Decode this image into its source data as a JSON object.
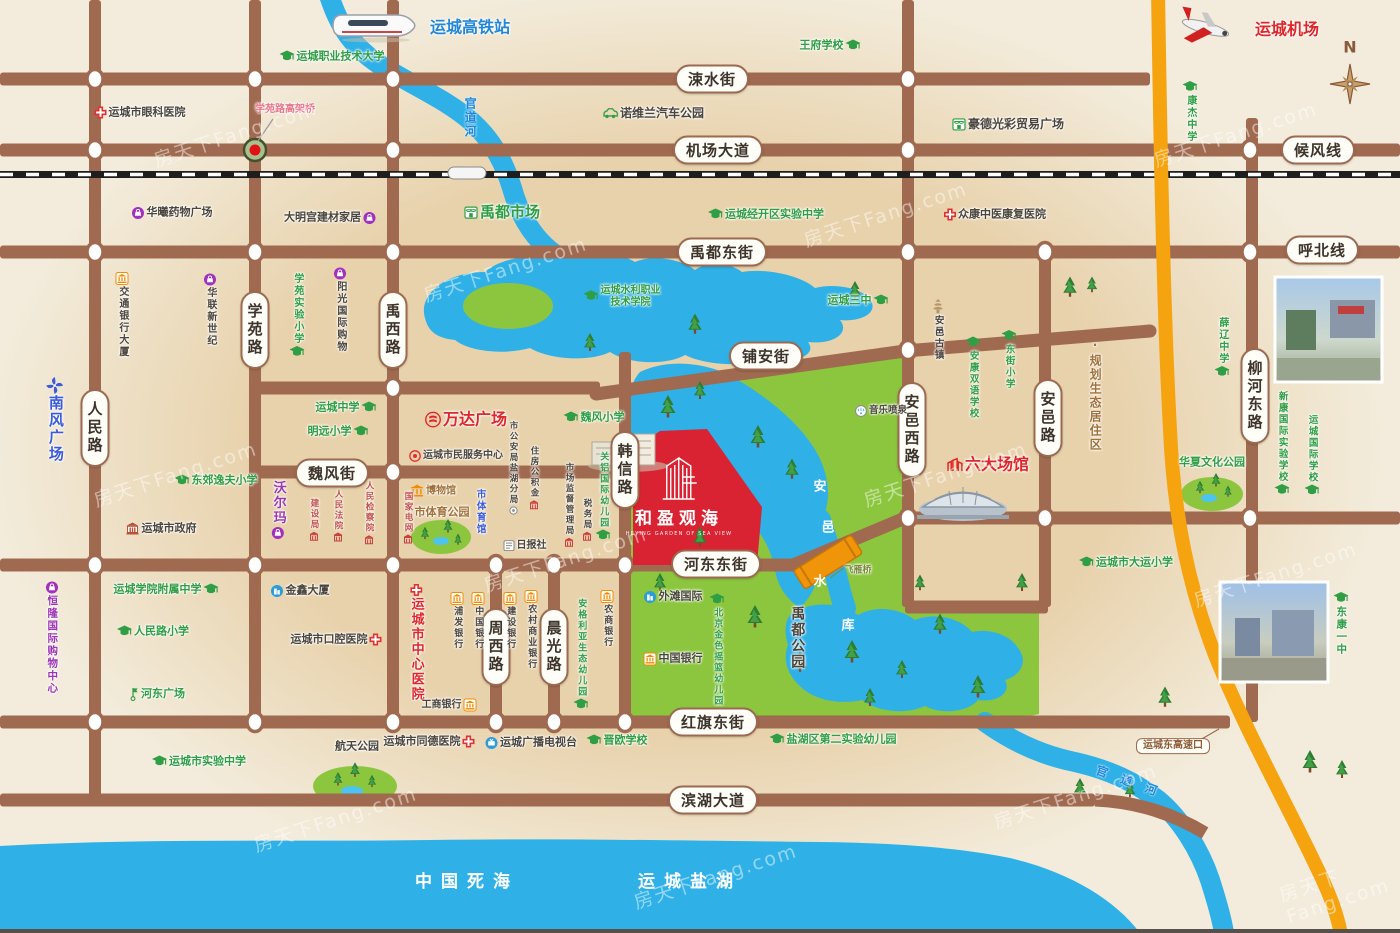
{
  "map": {
    "watermark": "房天下Fang.com",
    "compass_label": "N",
    "project": {
      "name": "和盈观海",
      "subtitle": "HEYING GARDEN OF SEA VIEW"
    },
    "colors": {
      "background": "#f3ecdc",
      "sand_zone": "#e8d2ac",
      "road": "#a06a50",
      "water": "#2fb1e8",
      "park": "#8cc63e",
      "highway": "#f5a40f",
      "project_red": "#da2332",
      "school_green": "#2f9e44",
      "landmark_red": "#e0262a",
      "shopping_purple": "#9c36b5",
      "bank_orange": "#f08c00"
    },
    "road_pills": [
      {
        "t": "涑水街",
        "x": 712,
        "y": 79
      },
      {
        "t": "机场大道",
        "x": 718,
        "y": 150
      },
      {
        "t": "候风线",
        "x": 1318,
        "y": 150
      },
      {
        "t": "禹都东街",
        "x": 722,
        "y": 252
      },
      {
        "t": "呼北线",
        "x": 1322,
        "y": 250
      },
      {
        "t": "铺安街",
        "x": 766,
        "y": 356
      },
      {
        "t": "学苑路",
        "x": 255,
        "y": 330,
        "v": true
      },
      {
        "t": "禹西路",
        "x": 393,
        "y": 330,
        "v": true
      },
      {
        "t": "人民路",
        "x": 95,
        "y": 428,
        "v": true
      },
      {
        "t": "魏风街",
        "x": 332,
        "y": 473
      },
      {
        "t": "韩信路",
        "x": 625,
        "y": 470,
        "v": true
      },
      {
        "t": "河东东街",
        "x": 716,
        "y": 564
      },
      {
        "t": "安邑西路",
        "x": 912,
        "y": 430,
        "v": true
      },
      {
        "t": "安邑路",
        "x": 1048,
        "y": 418,
        "v": true
      },
      {
        "t": "柳河东路",
        "x": 1255,
        "y": 396,
        "v": true
      },
      {
        "t": "周西路",
        "x": 496,
        "y": 647,
        "v": true
      },
      {
        "t": "晨光路",
        "x": 554,
        "y": 647,
        "v": true
      },
      {
        "t": "红旗东街",
        "x": 713,
        "y": 722
      },
      {
        "t": "滨湖大道",
        "x": 713,
        "y": 800
      }
    ],
    "pois": [
      {
        "t": "运城高铁站",
        "x": 470,
        "y": 28,
        "c": "blue",
        "fs": 16,
        "b": true
      },
      {
        "t": "运城职业技术大学",
        "x": 332,
        "y": 57,
        "c": "green",
        "i": "cap",
        "ip": "l",
        "fs": 11
      },
      {
        "t": "王府学校",
        "x": 830,
        "y": 46,
        "c": "green",
        "i": "cap",
        "ip": "r",
        "fs": 11
      },
      {
        "t": "运城机场",
        "x": 1287,
        "y": 30,
        "c": "red",
        "fs": 16,
        "b": true
      },
      {
        "t": "康杰中学",
        "x": 1190,
        "y": 112,
        "c": "green",
        "i": "cap",
        "ip": "t",
        "v": true,
        "fs": 10
      },
      {
        "t": "运城市眼科医院",
        "x": 140,
        "y": 113,
        "c": "dark",
        "i": "cross",
        "ip": "l",
        "fs": 11
      },
      {
        "t": "学苑路高架桥",
        "x": 285,
        "y": 110,
        "c": "pink",
        "fs": 10
      },
      {
        "t": "诺维兰汽车公园",
        "x": 653,
        "y": 113,
        "c": "dark",
        "i": "car",
        "ip": "l",
        "fs": 12
      },
      {
        "t": "豪德光彩贸易广场",
        "x": 1008,
        "y": 124,
        "c": "dark",
        "i": "market",
        "ip": "l",
        "fs": 12
      },
      {
        "t": "华曦药物广场",
        "x": 172,
        "y": 213,
        "c": "dark",
        "i": "shop",
        "ip": "l",
        "fs": 11
      },
      {
        "t": "大明宫建材家居",
        "x": 330,
        "y": 218,
        "c": "dark",
        "i": "shop",
        "ip": "r",
        "fs": 11
      },
      {
        "t": "禹都市场",
        "x": 502,
        "y": 213,
        "c": "green",
        "i": "market",
        "ip": "l",
        "fs": 15,
        "b": true
      },
      {
        "t": "运城经开区实验中学",
        "x": 766,
        "y": 215,
        "c": "green",
        "i": "cap",
        "ip": "l",
        "fs": 11
      },
      {
        "t": "众康中医康复医院",
        "x": 995,
        "y": 215,
        "c": "dark",
        "i": "cross",
        "ip": "l",
        "fs": 11
      },
      {
        "t": "交通银行大厦",
        "x": 122,
        "y": 315,
        "c": "dark",
        "i": "bank",
        "ip": "t",
        "v": true,
        "fs": 10
      },
      {
        "t": "华联新世纪",
        "x": 210,
        "y": 310,
        "c": "dark",
        "i": "shop",
        "ip": "t",
        "v": true,
        "fs": 10
      },
      {
        "t": "学苑实验小学",
        "x": 297,
        "y": 316,
        "c": "green",
        "i": "cap",
        "ip": "b",
        "v": true,
        "fs": 10
      },
      {
        "t": "阳光国际购物",
        "x": 340,
        "y": 310,
        "c": "dark",
        "i": "shop",
        "ip": "t",
        "v": true,
        "fs": 10
      },
      {
        "t": "南风广场",
        "x": 55,
        "y": 420,
        "c": "blue2",
        "i": "pinwheel",
        "ip": "t",
        "v": true,
        "fs": 15,
        "b": true
      },
      {
        "t": "运城水利职业\n技术学院",
        "x": 622,
        "y": 297,
        "c": "green",
        "i": "cap",
        "ip": "l",
        "fs": 10
      },
      {
        "t": "运城中学",
        "x": 346,
        "y": 408,
        "c": "green",
        "i": "cap",
        "ip": "r",
        "fs": 11
      },
      {
        "t": "明远小学",
        "x": 338,
        "y": 432,
        "c": "green",
        "i": "cap",
        "ip": "r",
        "fs": 11
      },
      {
        "t": "万达广场",
        "x": 466,
        "y": 420,
        "c": "red",
        "i": "wanda",
        "ip": "l",
        "fs": 16,
        "b": true
      },
      {
        "t": "运城市民服务中心",
        "x": 456,
        "y": 456,
        "c": "dark",
        "i": "serving",
        "ip": "l",
        "fs": 10
      },
      {
        "t": "博物馆",
        "x": 433,
        "y": 491,
        "c": "brown",
        "i": "museum",
        "ip": "l",
        "fs": 10
      },
      {
        "t": "市体育公园",
        "x": 442,
        "y": 513,
        "c": "brown",
        "fs": 11,
        "b": true
      },
      {
        "t": "市体育馆",
        "x": 480,
        "y": 512,
        "c": "blue2",
        "v": true,
        "fs": 9.5
      },
      {
        "t": "国家电网",
        "x": 408,
        "y": 518,
        "c": "darkred",
        "v": true,
        "fs": 8.5,
        "i": "redb",
        "ip": "b"
      },
      {
        "t": "日报社",
        "x": 525,
        "y": 546,
        "c": "dark",
        "i": "np",
        "ip": "l",
        "fs": 10
      },
      {
        "t": "市公安局盐湖分局",
        "x": 513,
        "y": 468,
        "c": "dark",
        "v": true,
        "fs": 8.5,
        "i": "dot",
        "ip": "b"
      },
      {
        "t": "住房公积金",
        "x": 534,
        "y": 478,
        "c": "dark",
        "v": true,
        "fs": 8.5,
        "i": "redb",
        "ip": "b"
      },
      {
        "t": "市场监督管理局",
        "x": 569,
        "y": 505,
        "c": "dark",
        "v": true,
        "fs": 8.5,
        "i": "redb",
        "ip": "b"
      },
      {
        "t": "税务局",
        "x": 587,
        "y": 520,
        "c": "dark",
        "v": true,
        "fs": 8.5,
        "i": "redb",
        "ip": "b"
      },
      {
        "t": "魏风小学",
        "x": 594,
        "y": 418,
        "c": "green",
        "i": "cap",
        "ip": "l",
        "fs": 11
      },
      {
        "t": "关铝国际幼儿园",
        "x": 603,
        "y": 497,
        "c": "green",
        "i": "cap",
        "ip": "b",
        "v": true,
        "fs": 9
      },
      {
        "t": "沃尔玛",
        "x": 278,
        "y": 510,
        "c": "purple",
        "i": "shop",
        "ip": "b",
        "v": true,
        "fs": 13,
        "b": true
      },
      {
        "t": "建设局",
        "x": 314,
        "y": 520,
        "c": "darkred",
        "v": true,
        "fs": 8.5,
        "i": "redb",
        "ip": "b"
      },
      {
        "t": "人民法院",
        "x": 338,
        "y": 516,
        "c": "darkred",
        "v": true,
        "fs": 8.5,
        "i": "redb",
        "ip": "b"
      },
      {
        "t": "人民检察院",
        "x": 369,
        "y": 513,
        "c": "darkred",
        "v": true,
        "fs": 8.5,
        "i": "redb",
        "ip": "b"
      },
      {
        "t": "东郊逸夫小学",
        "x": 216,
        "y": 481,
        "c": "green",
        "i": "cap",
        "ip": "l",
        "fs": 11
      },
      {
        "t": "运城市政府",
        "x": 161,
        "y": 529,
        "c": "dark",
        "i": "gov",
        "ip": "l",
        "fs": 11
      },
      {
        "t": "恒隆国际购物中心",
        "x": 52,
        "y": 638,
        "c": "purple",
        "i": "shop",
        "ip": "t",
        "v": true,
        "fs": 10.5
      },
      {
        "t": "运城学院附属中学",
        "x": 166,
        "y": 590,
        "c": "green",
        "i": "cap",
        "ip": "r",
        "fs": 11
      },
      {
        "t": "人民路小学",
        "x": 153,
        "y": 632,
        "c": "green",
        "i": "cap",
        "ip": "l",
        "fs": 11
      },
      {
        "t": "河东广场",
        "x": 156,
        "y": 694,
        "c": "green",
        "i": "flag",
        "ip": "l",
        "fs": 11
      },
      {
        "t": "金鑫大厦",
        "x": 300,
        "y": 591,
        "c": "dark",
        "i": "bldg",
        "ip": "l",
        "fs": 11
      },
      {
        "t": "运城市口腔医院",
        "x": 336,
        "y": 640,
        "c": "dark",
        "i": "cross",
        "ip": "r",
        "fs": 11
      },
      {
        "t": "运城市中心医院",
        "x": 416,
        "y": 643,
        "c": "red",
        "i": "cross",
        "ip": "t",
        "v": true,
        "fs": 13,
        "b": true
      },
      {
        "t": "浦发银行",
        "x": 457,
        "y": 621,
        "c": "dark",
        "i": "bank",
        "ip": "t",
        "v": true,
        "fs": 9
      },
      {
        "t": "中国银行",
        "x": 478,
        "y": 621,
        "c": "dark",
        "i": "bank",
        "ip": "t",
        "v": true,
        "fs": 9
      },
      {
        "t": "建设银行",
        "x": 510,
        "y": 621,
        "c": "dark",
        "i": "bank",
        "ip": "t",
        "v": true,
        "fs": 9
      },
      {
        "t": "农村商业银行",
        "x": 531,
        "y": 630,
        "c": "dark",
        "i": "bank",
        "ip": "t",
        "v": true,
        "fs": 9
      },
      {
        "t": "农商银行",
        "x": 607,
        "y": 619,
        "c": "dark",
        "i": "bank",
        "ip": "t",
        "v": true,
        "fs": 9
      },
      {
        "t": "安格利亚生态幼儿园",
        "x": 581,
        "y": 655,
        "c": "green",
        "i": "cap",
        "ip": "b",
        "v": true,
        "fs": 9
      },
      {
        "t": "工商银行",
        "x": 449,
        "y": 705,
        "c": "dark",
        "i": "bank",
        "ip": "r",
        "fs": 10
      },
      {
        "t": "中国银行",
        "x": 673,
        "y": 659,
        "c": "dark",
        "i": "bank",
        "ip": "l",
        "fs": 11
      },
      {
        "t": "外滩国际",
        "x": 673,
        "y": 597,
        "c": "dark",
        "i": "bldg",
        "ip": "l",
        "fs": 11
      },
      {
        "t": "北京金色摇篮幼儿园",
        "x": 717,
        "y": 650,
        "c": "green",
        "i": "cap",
        "ip": "t",
        "v": true,
        "fs": 9
      },
      {
        "t": "运城市同德医院",
        "x": 429,
        "y": 742,
        "c": "dark",
        "i": "cross",
        "ip": "r",
        "fs": 11
      },
      {
        "t": "运城广播电视台",
        "x": 531,
        "y": 743,
        "c": "dark",
        "i": "tv",
        "ip": "l",
        "fs": 11
      },
      {
        "t": "晋欧学校",
        "x": 617,
        "y": 741,
        "c": "green",
        "i": "cap",
        "ip": "l",
        "fs": 11
      },
      {
        "t": "盐湖区第二实验幼儿园",
        "x": 833,
        "y": 740,
        "c": "green",
        "i": "cap",
        "ip": "l",
        "fs": 11
      },
      {
        "t": "运城市实验中学",
        "x": 199,
        "y": 762,
        "c": "green",
        "i": "cap",
        "ip": "l",
        "fs": 11
      },
      {
        "t": "航天公园",
        "x": 357,
        "y": 747,
        "c": "dark",
        "fs": 11,
        "b": true
      },
      {
        "t": "运城三中",
        "x": 858,
        "y": 301,
        "c": "green",
        "i": "cap",
        "ip": "r",
        "fs": 11
      },
      {
        "t": "安邑古镇",
        "x": 938,
        "y": 330,
        "c": "dark",
        "i": "pagoda",
        "ip": "t",
        "v": true,
        "fs": 9.5
      },
      {
        "t": "安康双语学校",
        "x": 973,
        "y": 378,
        "c": "green",
        "i": "cap",
        "ip": "t",
        "v": true,
        "fs": 9.5
      },
      {
        "t": "东街小学",
        "x": 1009,
        "y": 360,
        "c": "green",
        "i": "cap",
        "ip": "t",
        "v": true,
        "fs": 9.5
      },
      {
        "t": "音乐喷泉",
        "x": 881,
        "y": 411,
        "c": "dark",
        "i": "fountain",
        "ip": "l",
        "fs": 9.5
      },
      {
        "t": "六大场馆",
        "x": 988,
        "y": 465,
        "c": "red",
        "i": "redbuilding",
        "ip": "l",
        "fs": 16,
        "b": true
      },
      {
        "t": "·规划生态居住区",
        "x": 1095,
        "y": 395,
        "c": "brown",
        "v": true,
        "fs": 12
      },
      {
        "t": "薛辽中学",
        "x": 1222,
        "y": 348,
        "c": "green",
        "i": "cap",
        "ip": "b",
        "v": true,
        "fs": 10
      },
      {
        "t": "新康国际实验学校",
        "x": 1282,
        "y": 444,
        "c": "green",
        "i": "cap",
        "ip": "b",
        "v": true,
        "fs": 9.5
      },
      {
        "t": "运城国际学校",
        "x": 1312,
        "y": 456,
        "c": "green",
        "i": "cap",
        "ip": "b",
        "v": true,
        "fs": 9.5
      },
      {
        "t": "华夏文化公园",
        "x": 1212,
        "y": 463,
        "c": "green",
        "fs": 11
      },
      {
        "t": "运城市大运小学",
        "x": 1126,
        "y": 563,
        "c": "green",
        "i": "cap",
        "ip": "l",
        "fs": 11
      },
      {
        "t": "东康一中",
        "x": 1341,
        "y": 624,
        "c": "green",
        "i": "cap",
        "ip": "t",
        "v": true,
        "fs": 10.5
      },
      {
        "t": "运城东高速口",
        "x": 1173,
        "y": 746,
        "c": "brown",
        "fs": 10,
        "box": true
      },
      {
        "t": "中国死海",
        "x": 467,
        "y": 882,
        "c": "white",
        "fs": 17,
        "ls": 9
      },
      {
        "t": "运城盐湖",
        "x": 690,
        "y": 882,
        "c": "white",
        "fs": 17,
        "ls": 9
      },
      {
        "t": "安",
        "x": 820,
        "y": 487,
        "c": "white",
        "fs": 13
      },
      {
        "t": "邑",
        "x": 828,
        "y": 528,
        "c": "white",
        "fs": 13
      },
      {
        "t": "水",
        "x": 820,
        "y": 582,
        "c": "white",
        "fs": 13
      },
      {
        "t": "库",
        "x": 848,
        "y": 626,
        "c": "white",
        "fs": 13
      },
      {
        "t": "禹都公园",
        "x": 797,
        "y": 638,
        "c": "dark",
        "v": true,
        "fs": 14,
        "ls": 5,
        "b": true
      },
      {
        "t": "官道河",
        "x": 470,
        "y": 118,
        "c": "blue3",
        "v": true,
        "fs": 12,
        "ls": 3
      },
      {
        "t": "官道河",
        "x": 1133,
        "y": 783,
        "c": "blue3",
        "fs": 12,
        "ls": 14,
        "rot": 20
      },
      {
        "t": "飞雁桥",
        "x": 858,
        "y": 571,
        "c": "olive",
        "fs": 9
      }
    ]
  }
}
